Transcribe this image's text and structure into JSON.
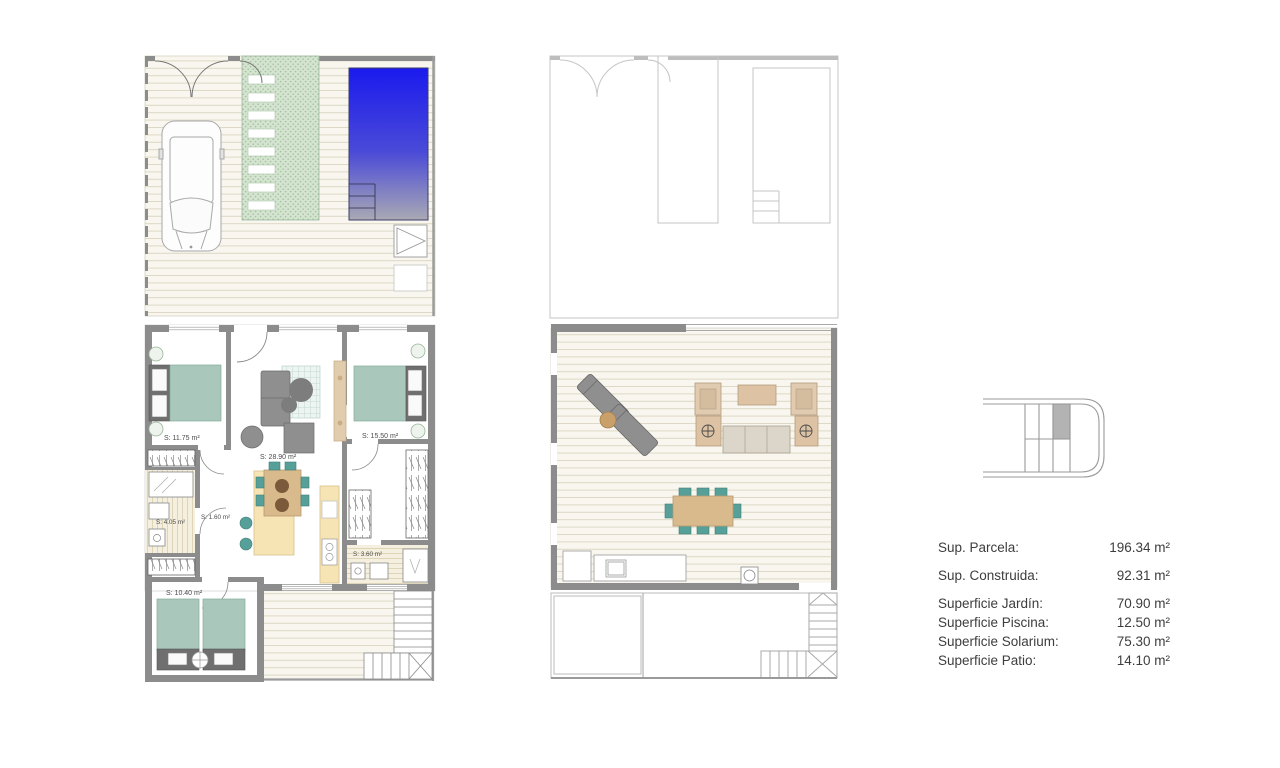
{
  "plans": {
    "ground_floor": {
      "rooms": [
        {
          "name": "bedroom-1",
          "label": "S: 11.75 m²"
        },
        {
          "name": "living-kitchen",
          "label": "S: 28.90 m²"
        },
        {
          "name": "bedroom-2",
          "label": "S: 15.50 m²"
        },
        {
          "name": "bathroom-1",
          "label": "S: 4.05 m²"
        },
        {
          "name": "hall",
          "label": "S: 1.60 m²"
        },
        {
          "name": "bathroom-2",
          "label": "S: 3.60 m²"
        },
        {
          "name": "bedroom-3",
          "label": "S: 10.40 m²"
        }
      ]
    },
    "upper_floor": {
      "rooms": []
    }
  },
  "legend": {
    "rows": [
      {
        "label": "Sup. Parcela:",
        "value": "196.34 m²"
      },
      {
        "label": "Sup. Construida:",
        "value": "92.31 m²"
      },
      {
        "label": "Superficie Jardín:",
        "value": "70.90 m²"
      },
      {
        "label": "Superficie Piscina:",
        "value": "12.50 m²"
      },
      {
        "label": "Superficie Solarium:",
        "value": "75.30 m²"
      },
      {
        "label": "Superficie Patio:",
        "value": "14.10 m²"
      }
    ]
  },
  "colors": {
    "pool_top": "#1a1aee",
    "pool_bottom": "#a9a9b4",
    "wall": "#8c8c8c",
    "bed_teal": "#a9c8bb",
    "furniture_gray": "#8f8f8f",
    "kitchen_cream": "#f7e4b5",
    "wood_tan": "#d8ba8c",
    "chair_teal": "#57a09a",
    "path_green": "#d4e4d0",
    "deck_base": "#f8f6ee"
  }
}
